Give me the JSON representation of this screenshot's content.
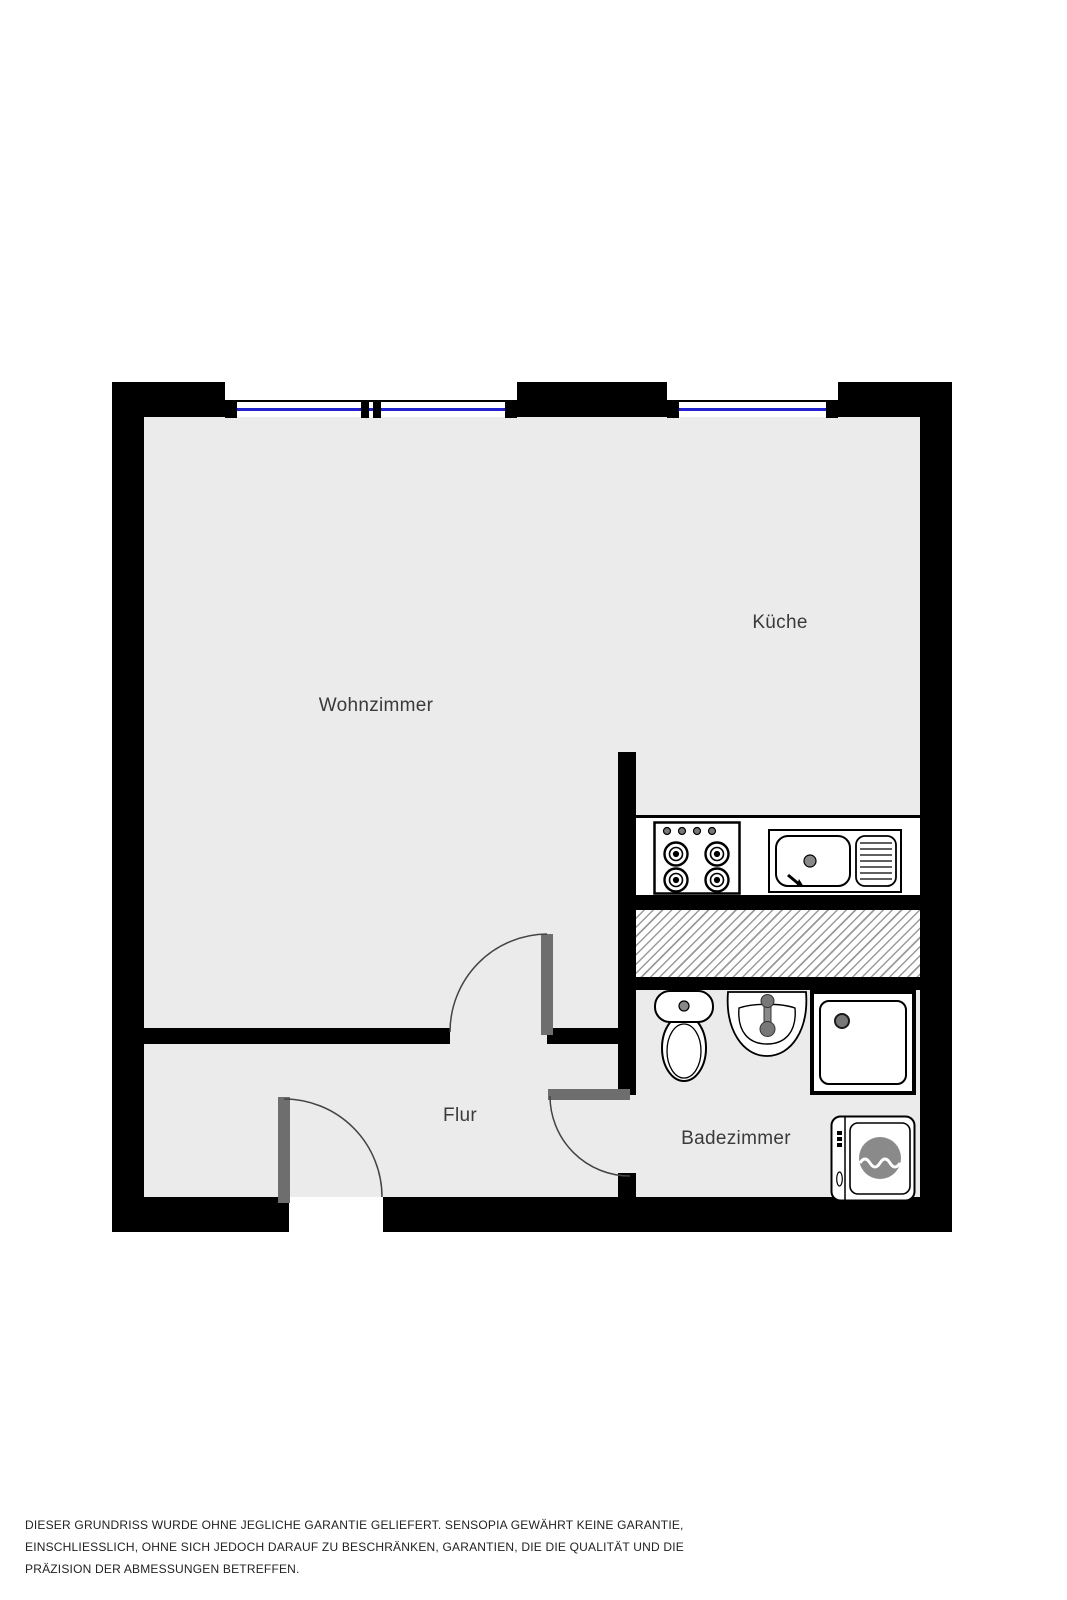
{
  "rooms": {
    "living_room": {
      "label": "Wohnzimmer"
    },
    "kitchen": {
      "label": "Küche"
    },
    "hallway": {
      "label": "Flur"
    },
    "bathroom": {
      "label": "Badezimmer"
    }
  },
  "fixtures": {
    "kitchen": [
      "stove-top",
      "kitchen-sink-with-drainboard"
    ],
    "bathroom": [
      "toilet",
      "washbasin",
      "shower",
      "washing-machine"
    ],
    "other": [
      "hatched-shaft-area",
      "window-living-room",
      "window-kitchen",
      "entrance-door",
      "living-room-door",
      "bathroom-door"
    ]
  },
  "colors": {
    "wall": "#000000",
    "floor": "#ebebeb",
    "window_glass": "#2121cf",
    "door_leaf": "#6e6e6e",
    "hatch_line": "#9a9a9a",
    "label_text": "#3a3a3a",
    "disclaimer_text": "#222222"
  },
  "disclaimer": {
    "lines": [
      "DIESER GRUNDRISS WURDE OHNE JEGLICHE GARANTIE GELIEFERT. SENSOPIA GEWÄHRT KEINE GARANTIE,",
      "EINSCHLIESSLICH, OHNE SICH JEDOCH DARAUF ZU BESCHRÄNKEN, GARANTIEN, DIE DIE QUALITÄT UND DIE",
      "PRÄZISION DER ABMESSUNGEN BETREFFEN."
    ]
  }
}
